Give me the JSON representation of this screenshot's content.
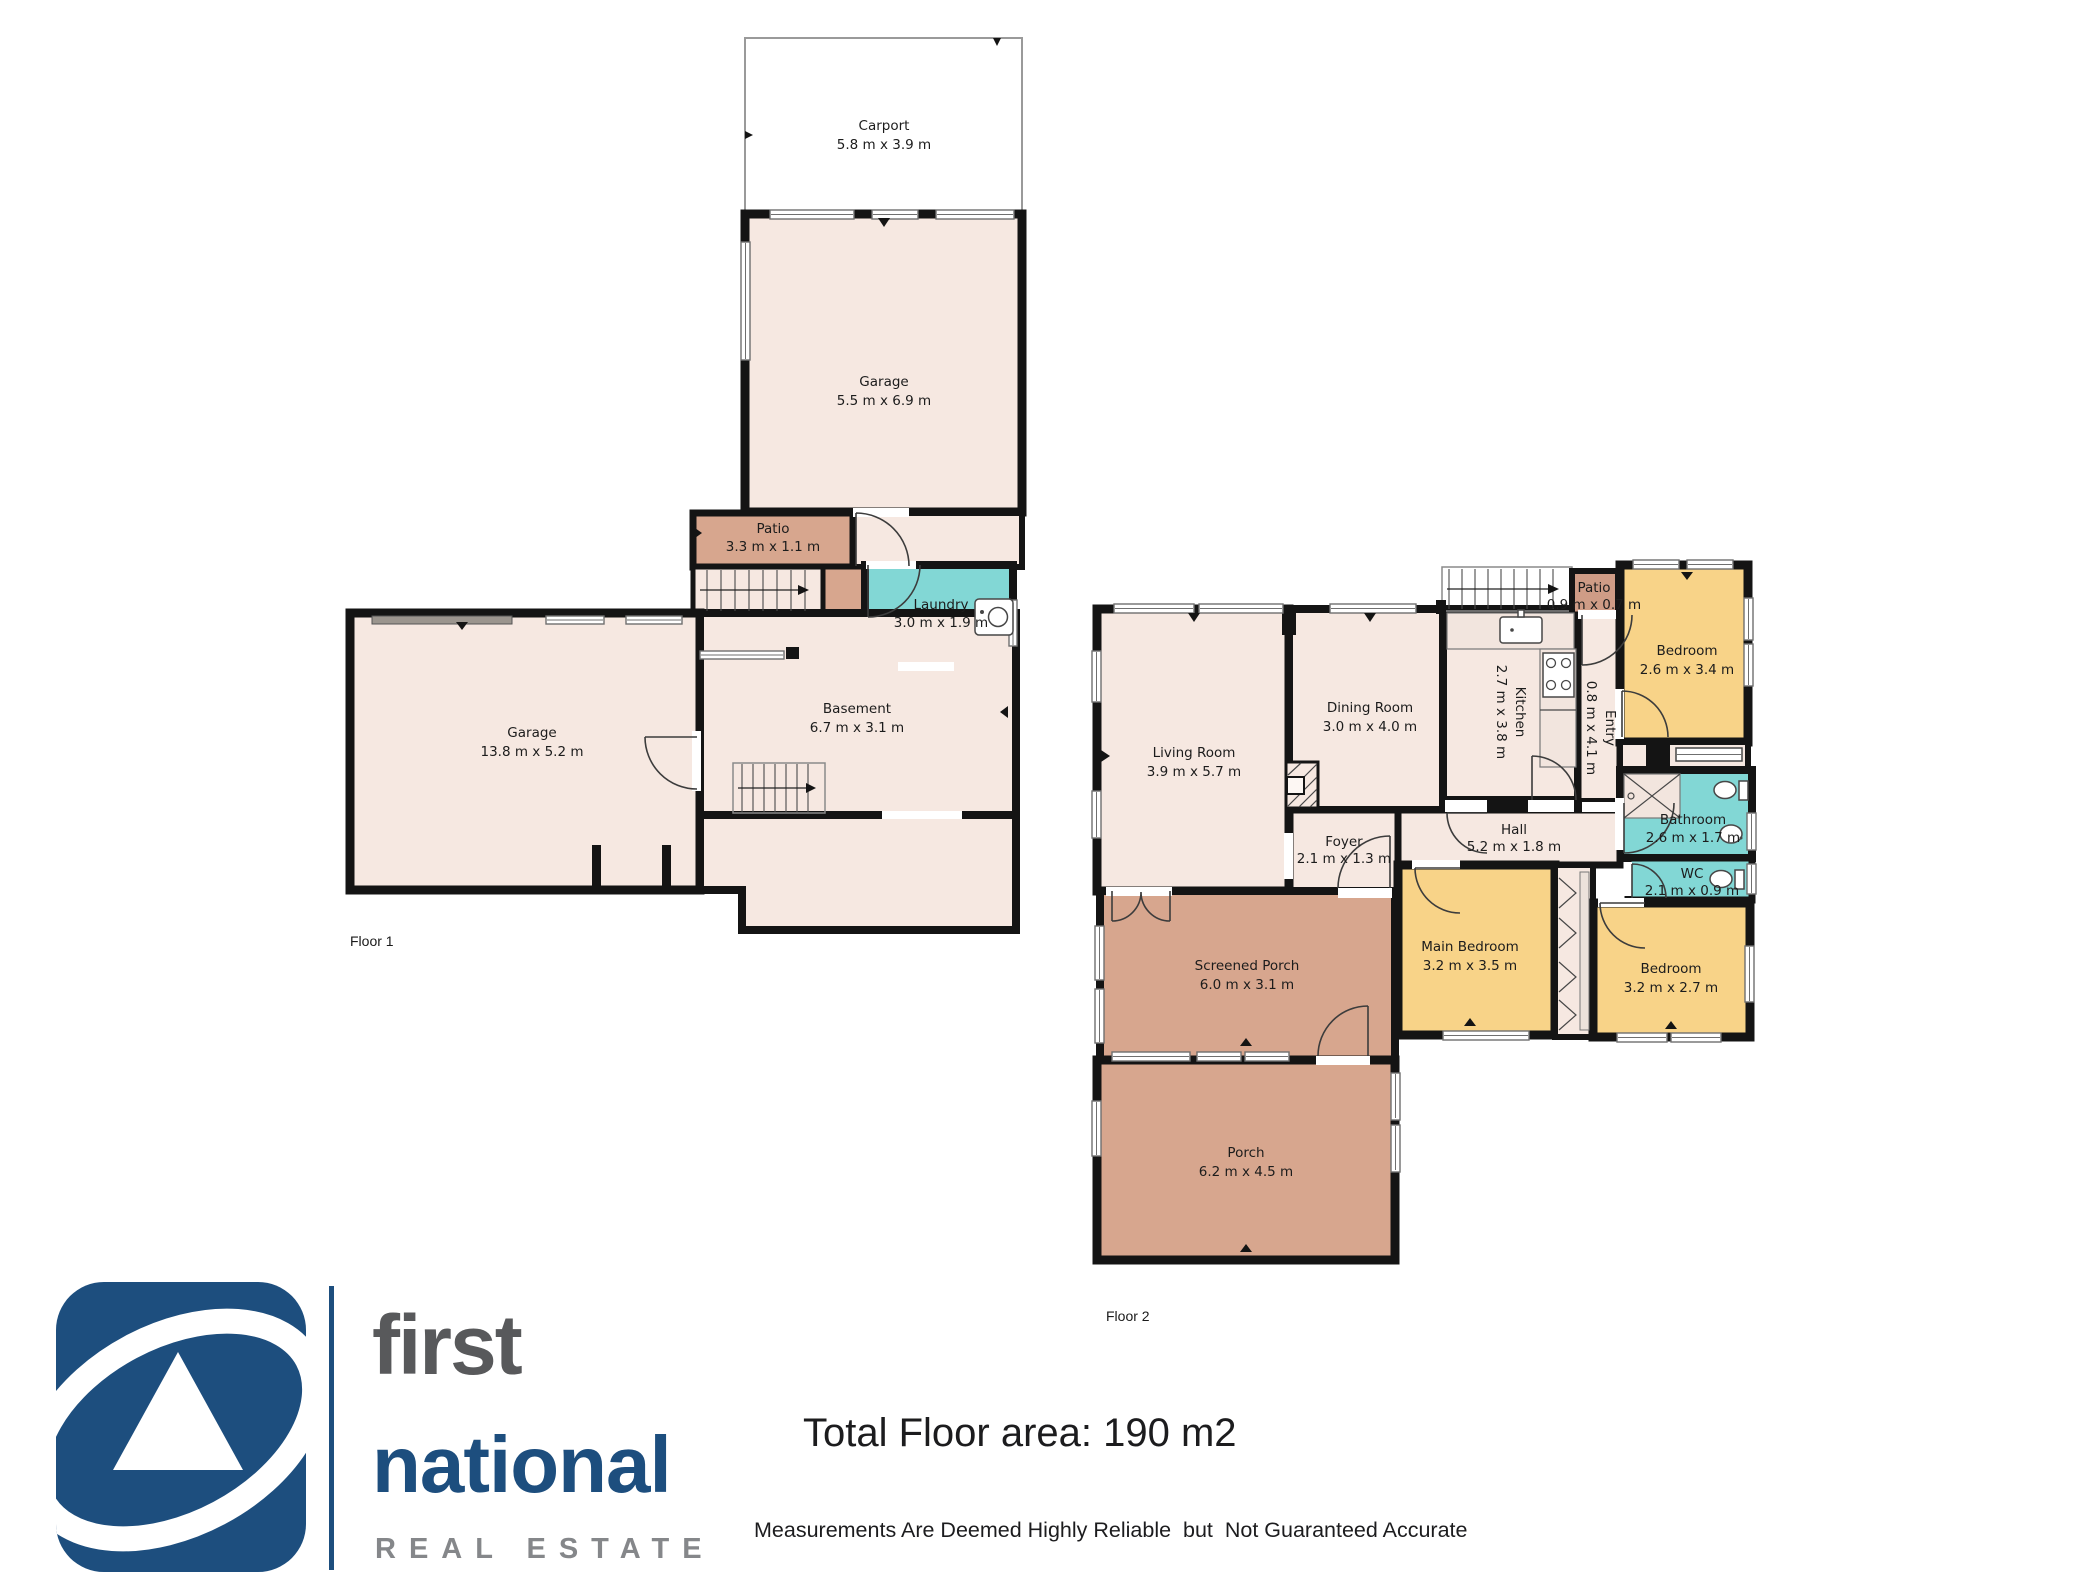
{
  "colors": {
    "beige": "#f6e8e1",
    "tan": "#d7a68e",
    "tan_dark": "#cf9c86",
    "teal": "#82d7d5",
    "yellow": "#f8d388",
    "wall": "#141414",
    "white": "#ffffff",
    "logo_blue": "#1d4e7e",
    "logo_gray": "#58595b",
    "logo_lightgray": "#85878a"
  },
  "floor1": {
    "label": "Floor 1",
    "rooms": {
      "carport": {
        "name": "Carport",
        "dims": "5.8 m x 3.9 m"
      },
      "garage_upper": {
        "name": "Garage",
        "dims": "5.5 m x 6.9 m"
      },
      "patio": {
        "name": "Patio",
        "dims": "3.3 m x 1.1 m"
      },
      "laundry": {
        "name": "Laundry",
        "dims": "3.0 m x 1.9 m"
      },
      "garage": {
        "name": "Garage",
        "dims": "13.8 m x 5.2 m"
      },
      "basement": {
        "name": "Basement",
        "dims": "6.7 m x 3.1 m"
      }
    }
  },
  "floor2": {
    "label": "Floor 2",
    "rooms": {
      "living": {
        "name": "Living Room",
        "dims": "3.9 m x 5.7 m"
      },
      "dining": {
        "name": "Dining Room",
        "dims": "3.0 m x 4.0 m"
      },
      "kitchen": {
        "name": "Kitchen",
        "dims": "2.7 m x 3.8 m"
      },
      "patio": {
        "name": "Patio",
        "dims": "0.9 m x 0.7 m"
      },
      "entry": {
        "name": "Entry",
        "dims": "0.8 m x 4.1 m"
      },
      "bedroom1": {
        "name": "Bedroom",
        "dims": "2.6 m x 3.4 m"
      },
      "bathroom": {
        "name": "Bathroom",
        "dims": "2.6 m x 1.7 m"
      },
      "wc": {
        "name": "WC",
        "dims": "2.1 m x 0.9 m"
      },
      "hall": {
        "name": "Hall",
        "dims": "5.2 m x 1.8 m"
      },
      "foyer": {
        "name": "Foyer",
        "dims": "2.1 m x 1.3 m"
      },
      "main_bedroom": {
        "name": "Main Bedroom",
        "dims": "3.2 m x 3.5 m"
      },
      "bedroom2": {
        "name": "Bedroom",
        "dims": "3.2 m x 2.7 m"
      },
      "screened_porch": {
        "name": "Screened Porch",
        "dims": "6.0 m x 3.1 m"
      },
      "porch": {
        "name": "Porch",
        "dims": "6.2 m x 4.5 m"
      }
    }
  },
  "footer": {
    "total_area": "Total Floor area: 190 m2",
    "disclaimer": "Measurements Are Deemed Highly Reliable  but  Not Guaranteed Accurate"
  },
  "logo": {
    "word1": "first",
    "word2": "national",
    "word3": "REAL ESTATE"
  }
}
